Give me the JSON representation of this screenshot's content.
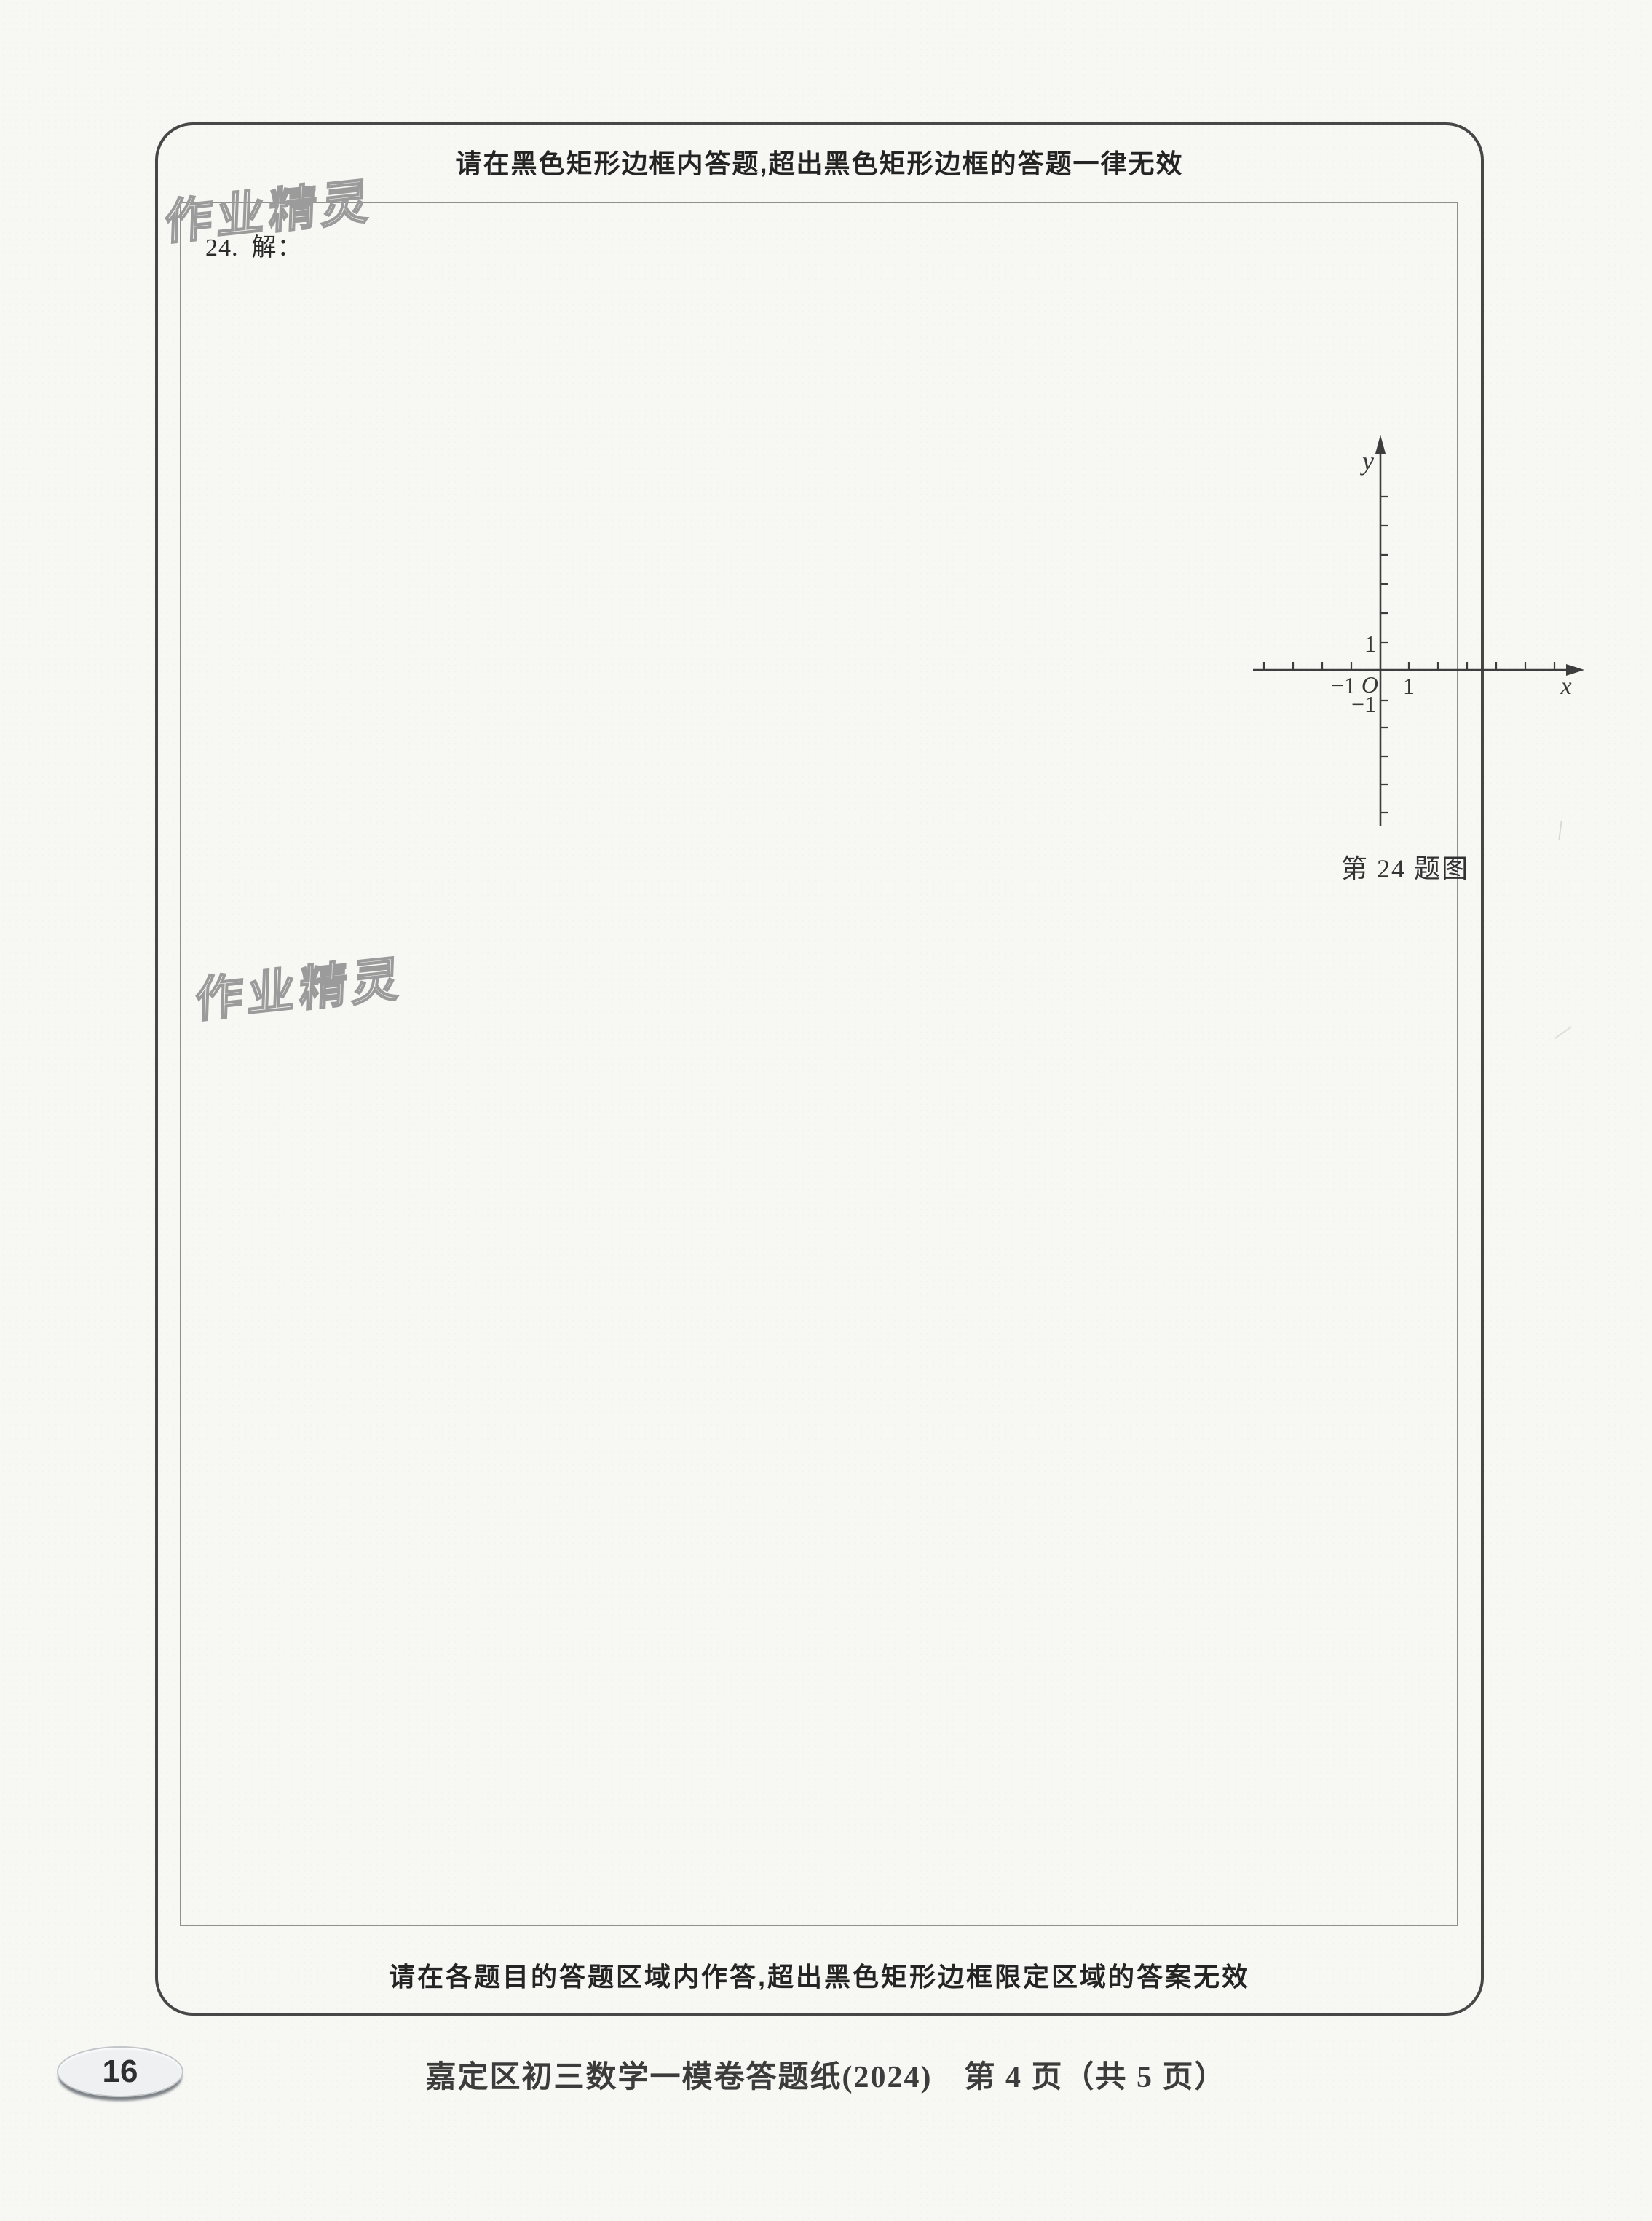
{
  "instructions": {
    "top": "请在黑色矩形边框内答题,超出黑色矩形边框的答题一律无效",
    "bottom": "请在各题目的答题区域内作答,超出黑色矩形边框限定区域的答案无效"
  },
  "question": {
    "number": "24.",
    "solution_label": "解："
  },
  "figure": {
    "caption": "第 24 题图",
    "labels": {
      "y_axis": "y",
      "x_axis": "x",
      "origin": "O",
      "y_1": "1",
      "x_1": "1",
      "x_neg_1": "−1",
      "y_neg_1": "−1"
    }
  },
  "watermark": {
    "text": "作业精灵"
  },
  "footer": {
    "page_badge": "16",
    "caption": "嘉定区初三数学一模卷答题纸(2024)　第 4 页（共 5 页）"
  },
  "colors": {
    "paper": "#f7f7f4",
    "ink": "#2e2e2e",
    "outer_border": "#474747",
    "inner_border": "#8f8f8f",
    "watermark_outline": "#9b9b9b",
    "badge_fill": "#eef0f1",
    "badge_shadow": "#7d8286"
  }
}
